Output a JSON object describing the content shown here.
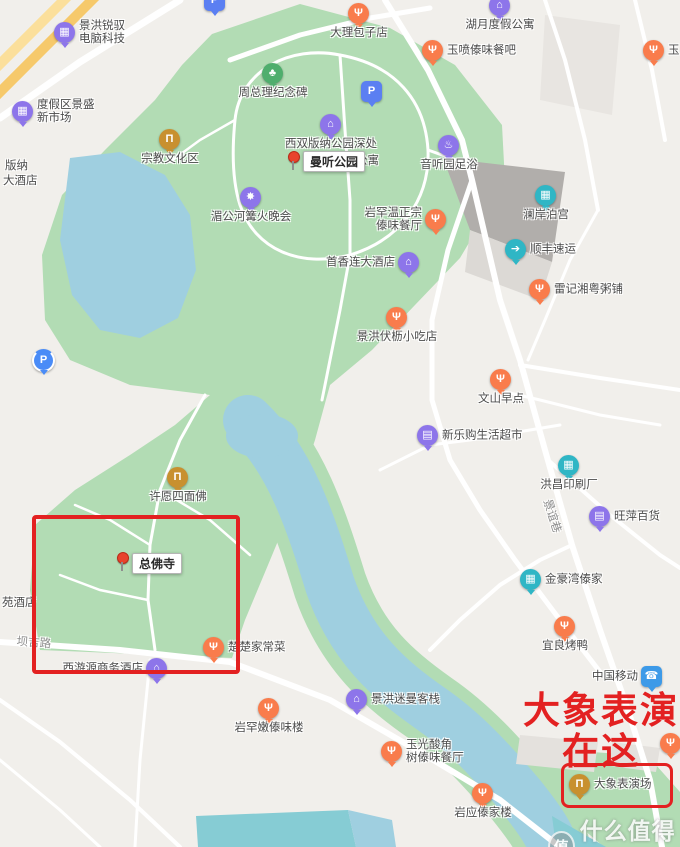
{
  "map_colors": {
    "background": "#f1efeb",
    "park_green": "#b2dcb4",
    "water": "#9fcfe0",
    "pool": "#86ccd4",
    "road": "#ffffff",
    "building_dark": "#b1aeab",
    "building_light": "#e8e5e1",
    "highway": "#f6c96b",
    "annotation_red": "#e32121"
  },
  "pin_types": {
    "food": {
      "color": "#f97c4c",
      "glyph": "Ψ"
    },
    "lodge": {
      "color": "#8d75ea",
      "glyph": "⌂"
    },
    "shop": {
      "color": "#8d75ea",
      "glyph": "▤"
    },
    "company": {
      "color": "#8d75ea",
      "glyph": "▦"
    },
    "spa": {
      "color": "#8d75ea",
      "glyph": "♨"
    },
    "attraction": {
      "color": "#8d75ea",
      "glyph": "✸"
    },
    "museum": {
      "color": "#c8902f",
      "glyph": "Π"
    },
    "teal": {
      "color": "#2fb6c5",
      "glyph": "▦"
    },
    "truck": {
      "color": "#2fb6c5",
      "glyph": "➔"
    },
    "monument": {
      "color": "#4fae6d",
      "glyph": "♣"
    },
    "mobile": {
      "color": "#3d9ae8",
      "glyph": "☎",
      "shape": "square"
    },
    "parking": {
      "color": "#5b7ff2",
      "glyph": "P",
      "shape": "square"
    },
    "parkingc": {
      "color": "#4a8cf7",
      "glyph": "P",
      "shape": "ring"
    }
  },
  "pois": [
    {
      "lines": [
        "景洪锐驭",
        "电脑科技"
      ],
      "t": "company",
      "x": 65,
      "y": 33,
      "lp": "right"
    },
    {
      "lines": [
        "度假区景盛",
        "新市场"
      ],
      "t": "company",
      "x": 23,
      "y": 112,
      "lp": "right"
    },
    {
      "lines": [
        "宗教文化区"
      ],
      "t": "museum",
      "x": 170,
      "y": 140,
      "lp": "below"
    },
    {
      "lines": [
        "周总理纪念碑"
      ],
      "t": "monument",
      "x": 273,
      "y": 74,
      "lp": "below"
    },
    {
      "lines": [
        "大理包子店"
      ],
      "t": "food",
      "x": 359,
      "y": 14,
      "lp": "below"
    },
    {
      "lines": [
        "湖月度假公寓"
      ],
      "t": "lodge",
      "x": 500,
      "y": 6,
      "lp": "below"
    },
    {
      "lines": [
        "玉喷傣味餐吧"
      ],
      "t": "food",
      "x": 433,
      "y": 51,
      "lp": "right"
    },
    {
      "lines": [
        "玉"
      ],
      "t": "food",
      "x": 654,
      "y": 51,
      "lp": "right"
    },
    {
      "lines": [
        "音听园足浴"
      ],
      "t": "spa",
      "x": 449,
      "y": 146,
      "lp": "below"
    },
    {
      "lines": [
        "澜岸泊宫"
      ],
      "t": "teal",
      "x": 546,
      "y": 196,
      "lp": "below"
    },
    {
      "lines": [
        "顺丰速运"
      ],
      "t": "truck",
      "x": 516,
      "y": 250,
      "lp": "right"
    },
    {
      "lines": [
        "雷记湘粤粥铺"
      ],
      "t": "food",
      "x": 540,
      "y": 290,
      "lp": "right"
    },
    {
      "lines": [
        "岩罕温正宗",
        "傣味餐厅"
      ],
      "t": "food",
      "x": 436,
      "y": 220,
      "lp": "left"
    },
    {
      "lines": [
        "首香连大酒店"
      ],
      "t": "lodge",
      "x": 409,
      "y": 263,
      "lp": "left"
    },
    {
      "lines": [
        "湄公河篝火晚会"
      ],
      "t": "attraction",
      "x": 251,
      "y": 198,
      "lp": "below"
    },
    {
      "lines": [
        "西双版纳公园深处"
      ],
      "t": "lodge",
      "x": 331,
      "y": 125,
      "lp": "below"
    },
    {
      "lines": [
        "景洪伏枥小吃店"
      ],
      "t": "food",
      "x": 397,
      "y": 318,
      "lp": "below"
    },
    {
      "lines": [
        "文山早点"
      ],
      "t": "food",
      "x": 501,
      "y": 380,
      "lp": "below"
    },
    {
      "lines": [
        "新乐购生活超市"
      ],
      "t": "shop",
      "x": 428,
      "y": 436,
      "lp": "right"
    },
    {
      "lines": [
        "洪昌印刷厂"
      ],
      "t": "teal",
      "x": 569,
      "y": 466,
      "lp": "below"
    },
    {
      "lines": [
        "旺萍百货"
      ],
      "t": "shop",
      "x": 600,
      "y": 517,
      "lp": "right"
    },
    {
      "lines": [
        "许愿四面佛"
      ],
      "t": "museum",
      "x": 178,
      "y": 478,
      "lp": "below"
    },
    {
      "lines": [
        "金豪湾傣家"
      ],
      "t": "teal",
      "x": 531,
      "y": 580,
      "lp": "right"
    },
    {
      "lines": [
        "宜良烤鸭"
      ],
      "t": "food",
      "x": 565,
      "y": 627,
      "lp": "below"
    },
    {
      "lines": [
        "楚楚家常菜"
      ],
      "t": "food",
      "x": 214,
      "y": 648,
      "lp": "right"
    },
    {
      "lines": [
        "西游源商务酒店"
      ],
      "t": "lodge",
      "x": 157,
      "y": 669,
      "lp": "left"
    },
    {
      "lines": [
        "景洪迷曼客栈"
      ],
      "t": "lodge",
      "x": 357,
      "y": 700,
      "lp": "right"
    },
    {
      "lines": [
        "岩罕嫩傣味楼"
      ],
      "t": "food",
      "x": 269,
      "y": 709,
      "lp": "below"
    },
    {
      "lines": [
        "玉光酸角",
        "树傣味餐厅"
      ],
      "t": "food",
      "x": 392,
      "y": 752,
      "lp": "right"
    },
    {
      "lines": [
        "中国移动"
      ],
      "t": "mobile",
      "x": 652,
      "y": 677,
      "lp": "left"
    },
    {
      "lines": [
        "岩应傣家楼"
      ],
      "t": "food",
      "x": 483,
      "y": 794,
      "lp": "below"
    },
    {
      "lines": [
        "大象表演场"
      ],
      "t": "museum",
      "x": 580,
      "y": 785,
      "lp": "right"
    },
    {
      "lines": [],
      "t": "food",
      "x": 671,
      "y": 744,
      "lp": "below"
    },
    {
      "lines": [],
      "t": "parking",
      "x": 372,
      "y": 92,
      "lp": "below"
    },
    {
      "lines": [],
      "t": "parkingc",
      "x": 43,
      "y": 360,
      "lp": "below"
    },
    {
      "lines": [],
      "t": "parking",
      "x": 215,
      "y": 1,
      "lp": "below"
    }
  ],
  "selected_pois": [
    {
      "label": "曼听公园",
      "pin_x": 293,
      "pin_y": 156,
      "box_x": 303,
      "box_y": 151
    },
    {
      "label": "总佛寺",
      "pin_x": 122,
      "pin_y": 557,
      "box_x": 132,
      "box_y": 553
    }
  ],
  "texts": [
    {
      "text": "版纳",
      "x": 5,
      "y": 160,
      "rot": 0,
      "road": false
    },
    {
      "text": "大酒店",
      "x": 3,
      "y": 175,
      "rot": 0,
      "road": false
    },
    {
      "text": "苑酒店",
      "x": 2,
      "y": 597,
      "rot": 0,
      "road": false
    },
    {
      "text": "公寓",
      "x": 356,
      "y": 155,
      "rot": 0,
      "road": false
    },
    {
      "text": "坝吉路",
      "x": 17,
      "y": 636,
      "rot": 4,
      "road": true
    },
    {
      "text": "景谊巷",
      "x": 552,
      "y": 498,
      "rot": 72,
      "road": true
    }
  ],
  "annotation": {
    "big_text": [
      "大象表演",
      "在这"
    ],
    "color": "#e32121",
    "boxes": [
      {
        "x": 32,
        "y": 515,
        "w": 200,
        "h": 151,
        "border": 4,
        "radius": 4
      },
      {
        "x": 561,
        "y": 763,
        "w": 106,
        "h": 39,
        "border": 3,
        "radius": 8
      }
    ]
  },
  "watermark": {
    "logo": "值",
    "text": "什么值得买"
  }
}
